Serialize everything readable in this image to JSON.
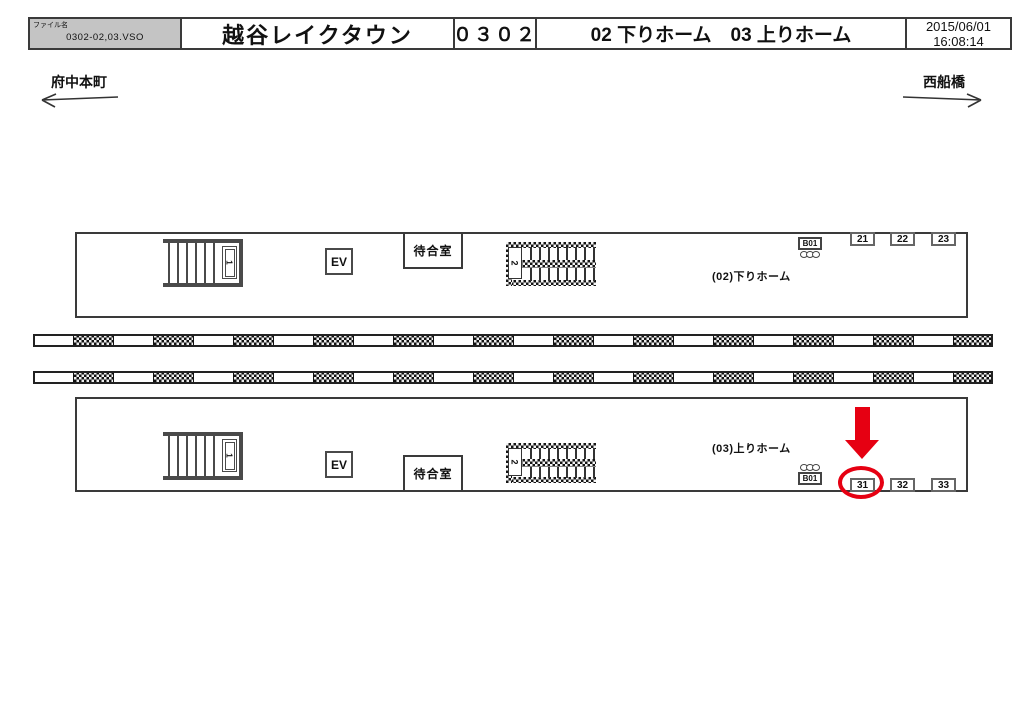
{
  "header": {
    "file_label": "ファイル名",
    "file_name": "0302-02,03.VSO",
    "station_name": "越谷レイクタウン",
    "station_code": "０３０２",
    "platforms_title": "02 下りホーム　03 上りホーム",
    "date": "2015/06/01",
    "time": "16:08:14"
  },
  "directions": {
    "left": "府中本町",
    "right": "西船橋"
  },
  "platform_down": {
    "label": "(02)下りホーム",
    "elevator_label": "EV",
    "waiting_room_label": "待合室",
    "stair_no": "1",
    "hatched_stair_no": "2",
    "sign_label": "B01",
    "positions": [
      "21",
      "22",
      "23"
    ]
  },
  "platform_up": {
    "label": "(03)上りホーム",
    "elevator_label": "EV",
    "waiting_room_label": "待合室",
    "stair_no": "1",
    "hatched_stair_no": "2",
    "sign_label": "B01",
    "positions": [
      "31",
      "32",
      "33"
    ],
    "highlighted_position": "31"
  },
  "colors": {
    "highlight_red": "#e60012",
    "header_fill": "#c4c4c4",
    "line": "#3a3a3a"
  }
}
